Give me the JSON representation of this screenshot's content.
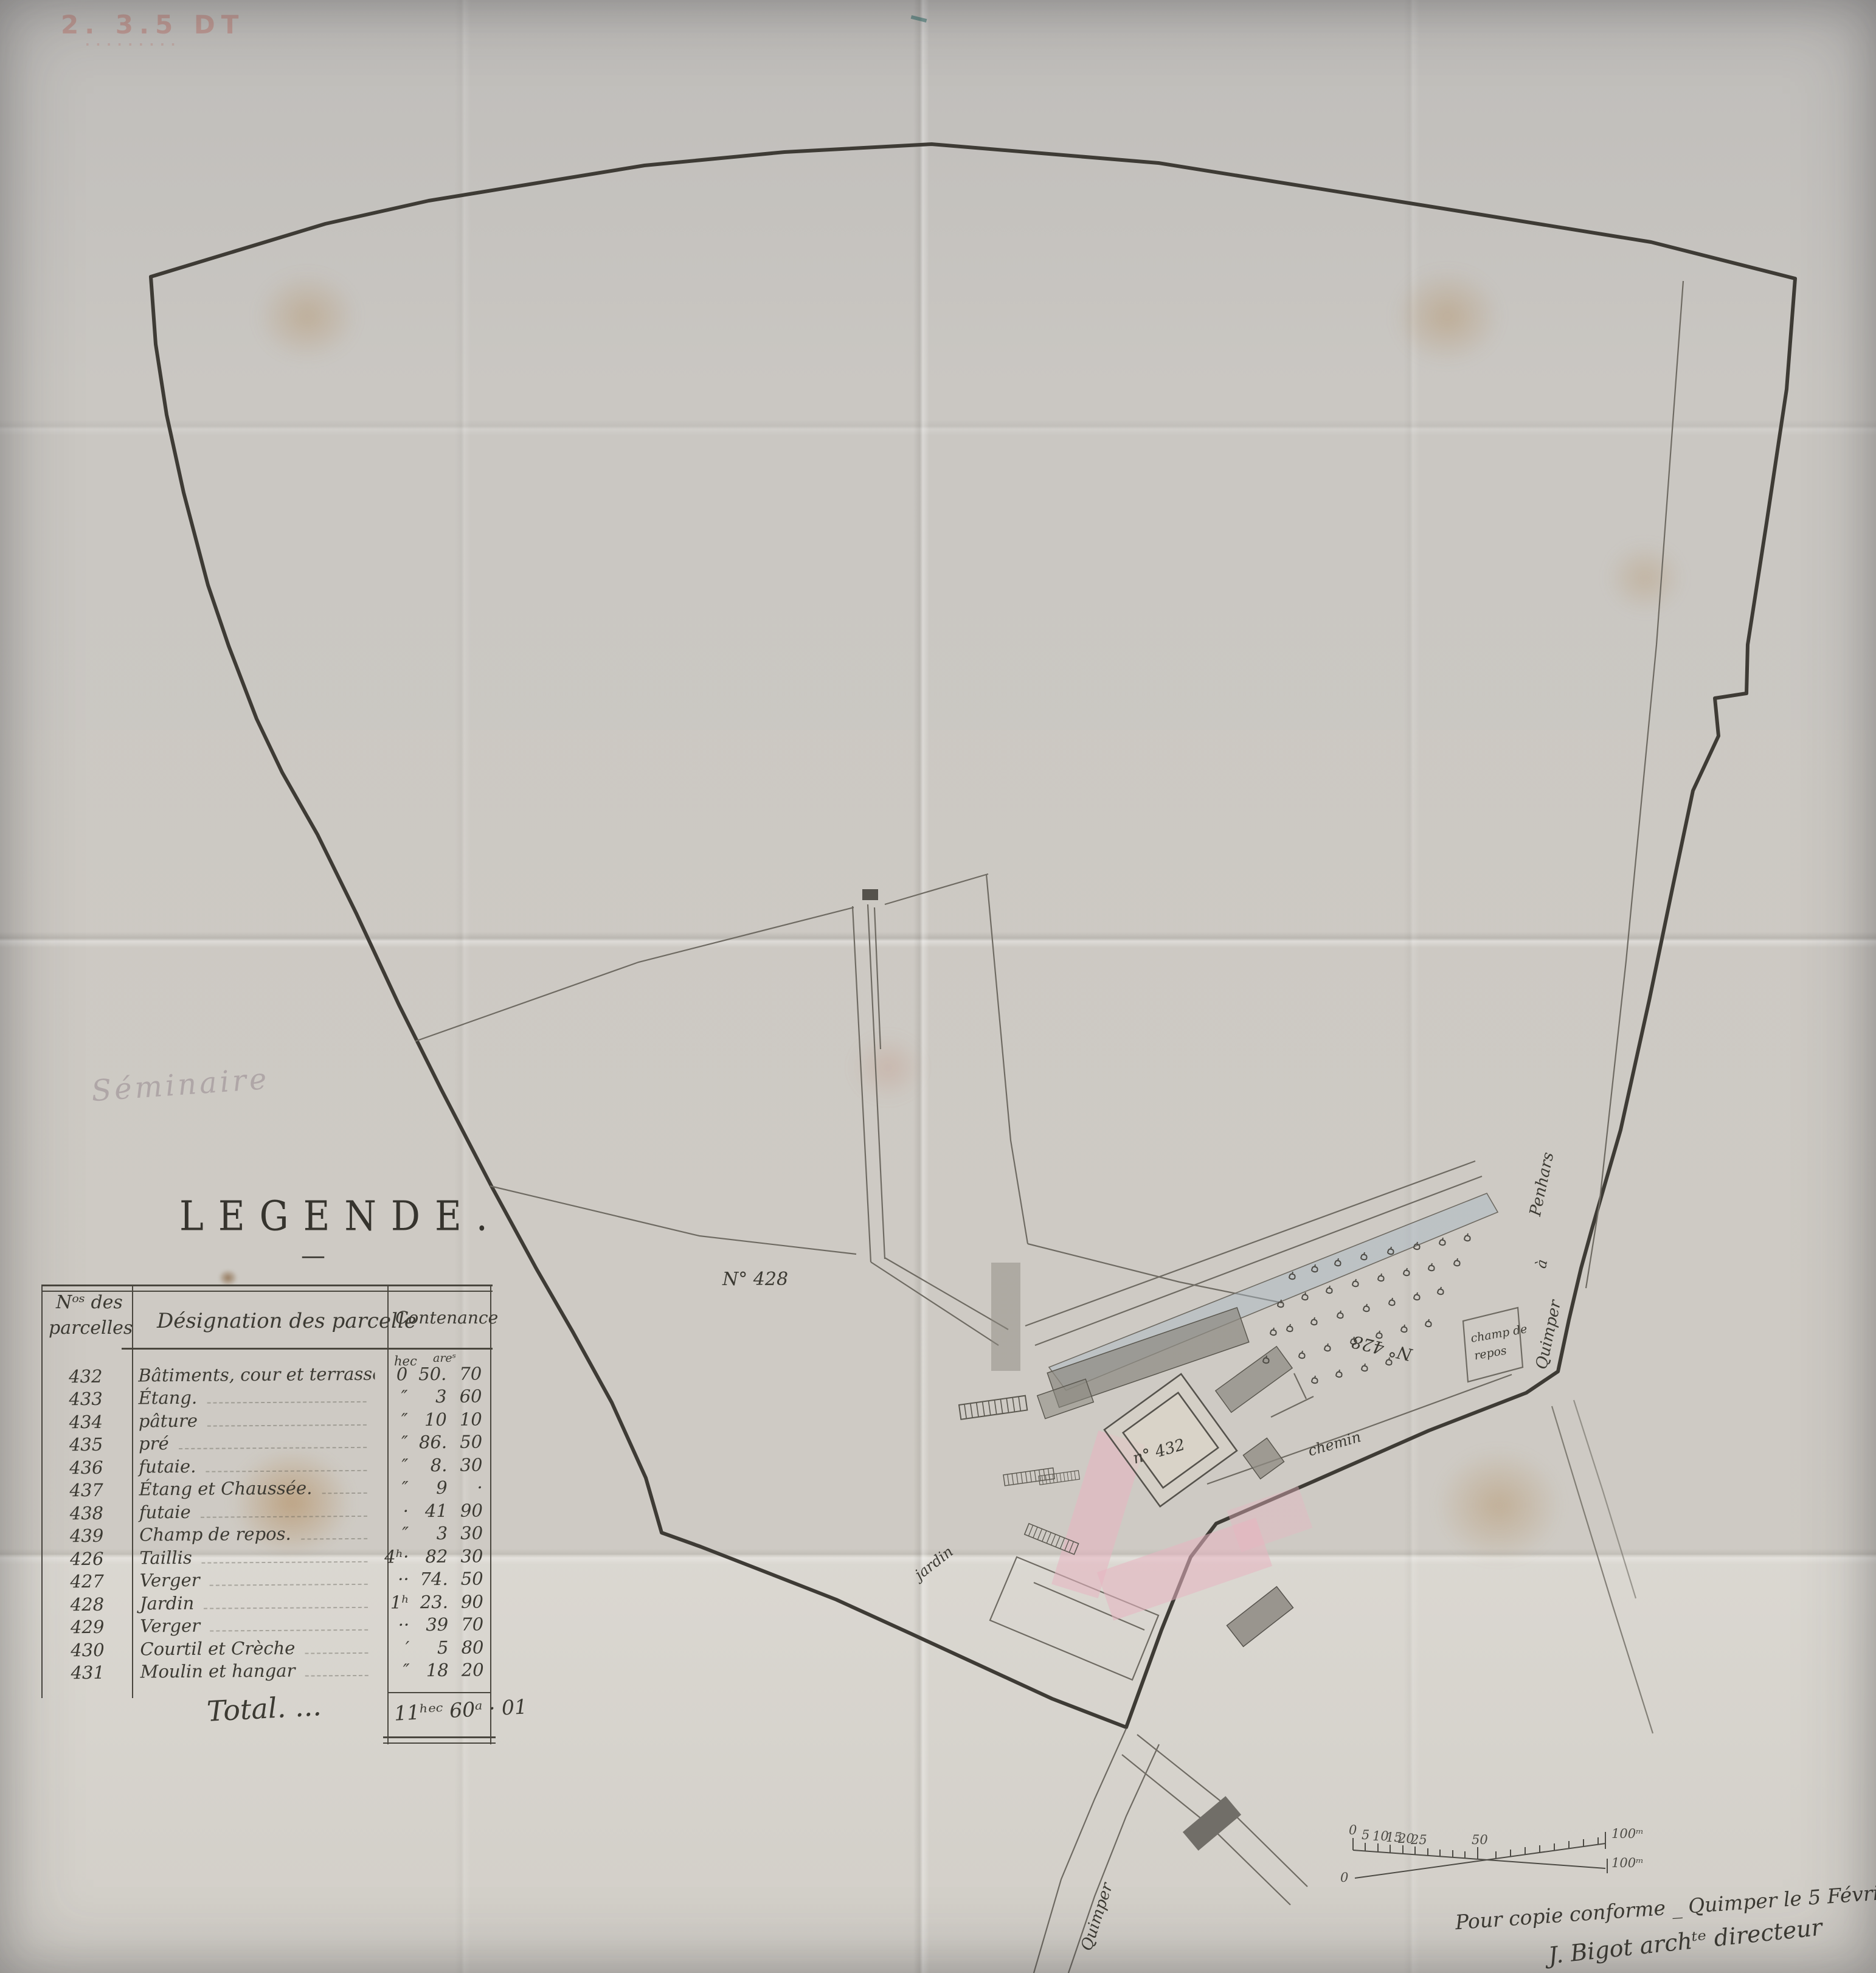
{
  "doc": {
    "stamp": {
      "line1": "2. 3.5 DT",
      "line2": "........."
    },
    "pencil_note": "Séminaire",
    "legend": {
      "title": "LEGENDE.",
      "title_dash": "—",
      "header": {
        "col1_line1": "Nᵒˢ des",
        "col1_line2": "parcelles",
        "col2": "Désignation des parcelle",
        "col3": "Contenance",
        "unit_hec": "hec",
        "unit_are": "areˢ"
      },
      "rows": [
        {
          "num": "432",
          "designation": "Bâtiments, cour et terrasse",
          "hec": "0",
          "are": "50.",
          "cent": "70"
        },
        {
          "num": "433",
          "designation": "Étang.",
          "hec": "″",
          "are": "3",
          "cent": "60"
        },
        {
          "num": "434",
          "designation": "pâture",
          "hec": "″",
          "are": "10",
          "cent": "10"
        },
        {
          "num": "435",
          "designation": "pré",
          "hec": "″",
          "are": "86.",
          "cent": "50"
        },
        {
          "num": "436",
          "designation": "futaie.",
          "hec": "″",
          "are": "8.",
          "cent": "30"
        },
        {
          "num": "437",
          "designation": "Étang et Chaussée.",
          "hec": "″",
          "are": "9",
          "cent": "·"
        },
        {
          "num": "438",
          "designation": "futaie",
          "hec": "·",
          "are": "41",
          "cent": "90"
        },
        {
          "num": "439",
          "designation": "Champ de repos.",
          "hec": "″",
          "are": "3",
          "cent": "30"
        },
        {
          "num": "426",
          "designation": "Taillis",
          "hec": "4ʰ·",
          "are": "82",
          "cent": "30"
        },
        {
          "num": "427",
          "designation": "Verger",
          "hec": "··",
          "are": "74.",
          "cent": "50"
        },
        {
          "num": "428",
          "designation": "Jardin",
          "hec": "1ʰ",
          "are": "23.",
          "cent": "90"
        },
        {
          "num": "429",
          "designation": "Verger",
          "hec": "··",
          "are": "39",
          "cent": "70"
        },
        {
          "num": "430",
          "designation": "Courtil et Crèche",
          "hec": "′",
          "are": "5",
          "cent": "80"
        },
        {
          "num": "431",
          "designation": "Moulin et hangar",
          "hec": "″",
          "are": "18",
          "cent": "20"
        }
      ],
      "total_label": "Total. ...",
      "total_value": "11ʰᵉᶜ 60ᵃ · 01"
    },
    "map_labels": {
      "parcel_left": "N° 428",
      "parcel_right": "N° 428",
      "courtyard": "n° 432",
      "champ_line1": "champ de",
      "champ_line2": "repos",
      "chemin": "chemin",
      "jardin": "jardin",
      "road_right_top": "Penhars",
      "road_right_mid": "à",
      "road_right_bottom": "Quimper",
      "road_bottom": "Quimper"
    },
    "scale_bar": {
      "zero_top": "0",
      "zero_bottom": "0",
      "t5": "5",
      "t10": "10",
      "t15": "15",
      "t20": "20",
      "t25": "25",
      "t50": "50",
      "right_top": "100ᵐ",
      "right_bottom": "100ᵐ"
    },
    "signature": {
      "line1": "Pour copie conforme _ Quimper le 5 Février 1881.",
      "line2": "J. Bigot archᵗᵉ directeur"
    },
    "colors": {
      "paper": "#cbc8c3",
      "ink_dark": "#3e3b35",
      "ink_thin": "#6e6a62",
      "wash_gray": "#8d8a82",
      "wash_pink": "#e7b5c1",
      "wash_blue": "#a9b8c6",
      "stain": "#b08a5a",
      "stamp_red": "#ba4638"
    }
  }
}
